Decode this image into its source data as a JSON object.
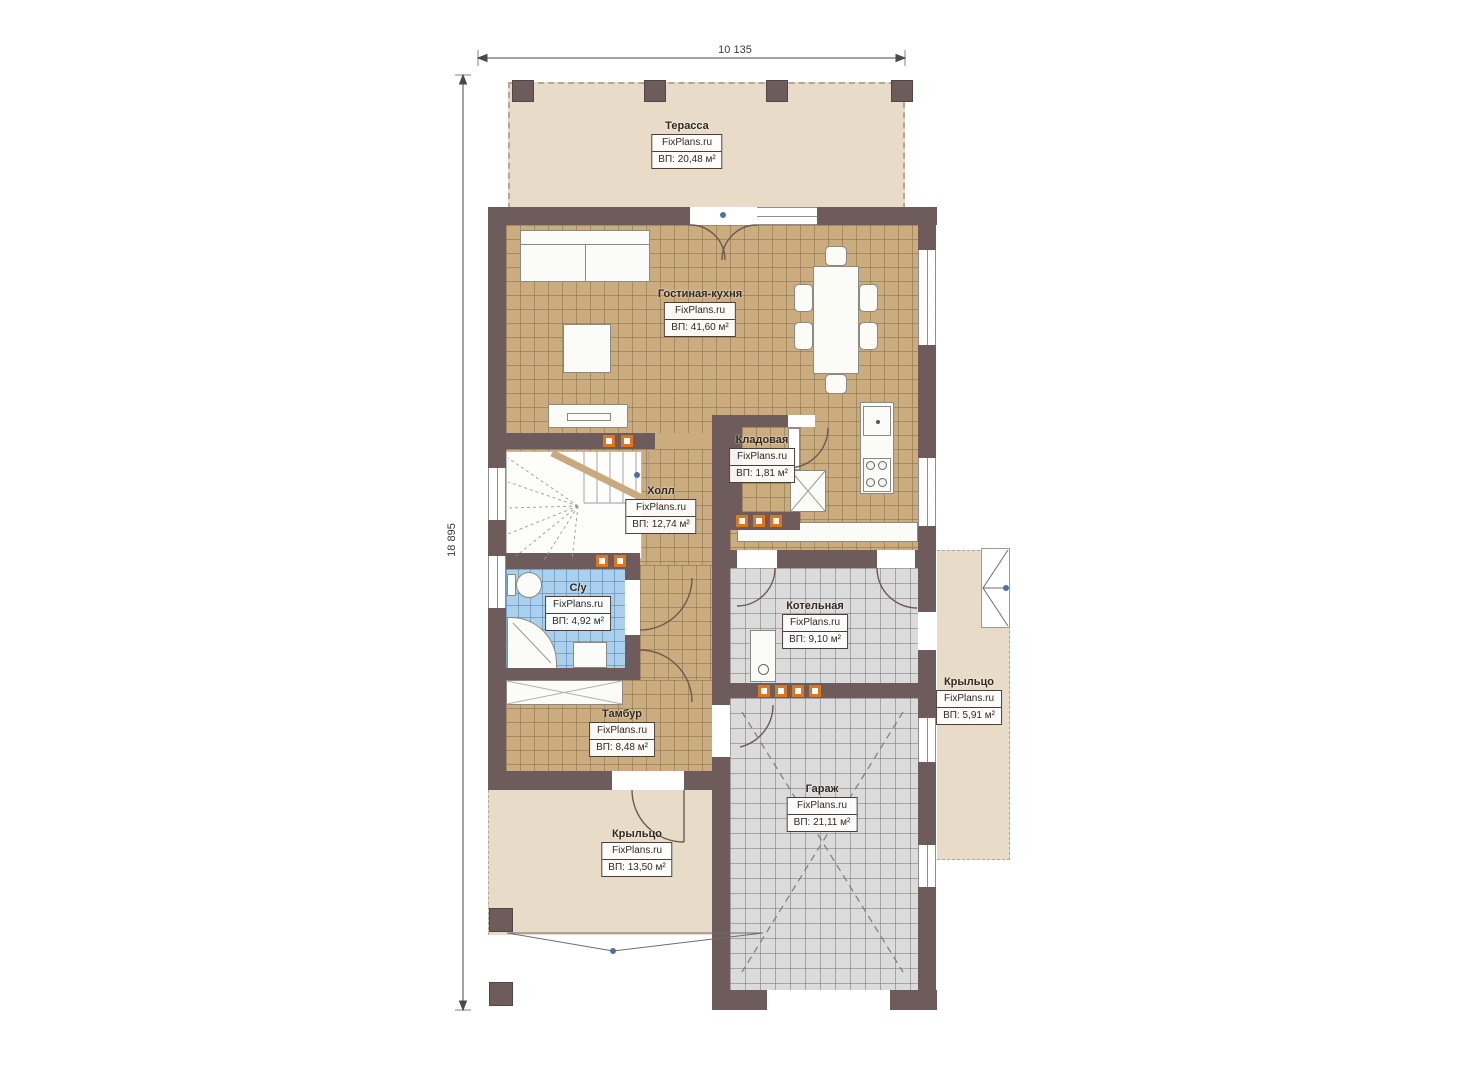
{
  "document": {
    "type": "floor-plan"
  },
  "brand": "FixPlans.ru",
  "dimensions": {
    "width_label": "10 135",
    "height_label": "18 895"
  },
  "rooms": [
    {
      "id": "terrace",
      "name": "Терасса",
      "brand": "FixPlans.ru",
      "area": "ВП: 20,48 м²"
    },
    {
      "id": "living-kitchen",
      "name": "Гостиная-кухня",
      "brand": "FixPlans.ru",
      "area": "ВП: 41,60 м²"
    },
    {
      "id": "storage",
      "name": "Кладовая",
      "brand": "FixPlans.ru",
      "area": "ВП: 1,81 м²"
    },
    {
      "id": "hall",
      "name": "Холл",
      "brand": "FixPlans.ru",
      "area": "ВП: 12,74 м²"
    },
    {
      "id": "bathroom",
      "name": "С/у",
      "brand": "FixPlans.ru",
      "area": "ВП: 4,92 м²"
    },
    {
      "id": "boiler-room",
      "name": "Котельная",
      "brand": "FixPlans.ru",
      "area": "ВП: 9,10 м²"
    },
    {
      "id": "vestibule",
      "name": "Тамбур",
      "brand": "FixPlans.ru",
      "area": "ВП: 8,48 м²"
    },
    {
      "id": "porch-right",
      "name": "Крыльцо",
      "brand": "FixPlans.ru",
      "area": "ВП: 5,91 м²"
    },
    {
      "id": "garage",
      "name": "Гараж",
      "brand": "FixPlans.ru",
      "area": "ВП: 21,11 м²"
    },
    {
      "id": "porch-bottom",
      "name": "Крыльцо",
      "brand": "FixPlans.ru",
      "area": "ВП: 13,50 м²"
    }
  ],
  "colors": {
    "wall": "#6e5c5c",
    "floor_tan": "#cbac7f",
    "floor_gray": "#dbdbdb",
    "floor_blue": "#aad0ec",
    "outdoor_beige": "#e8dcc8",
    "vent_orange": "#e0761b"
  }
}
